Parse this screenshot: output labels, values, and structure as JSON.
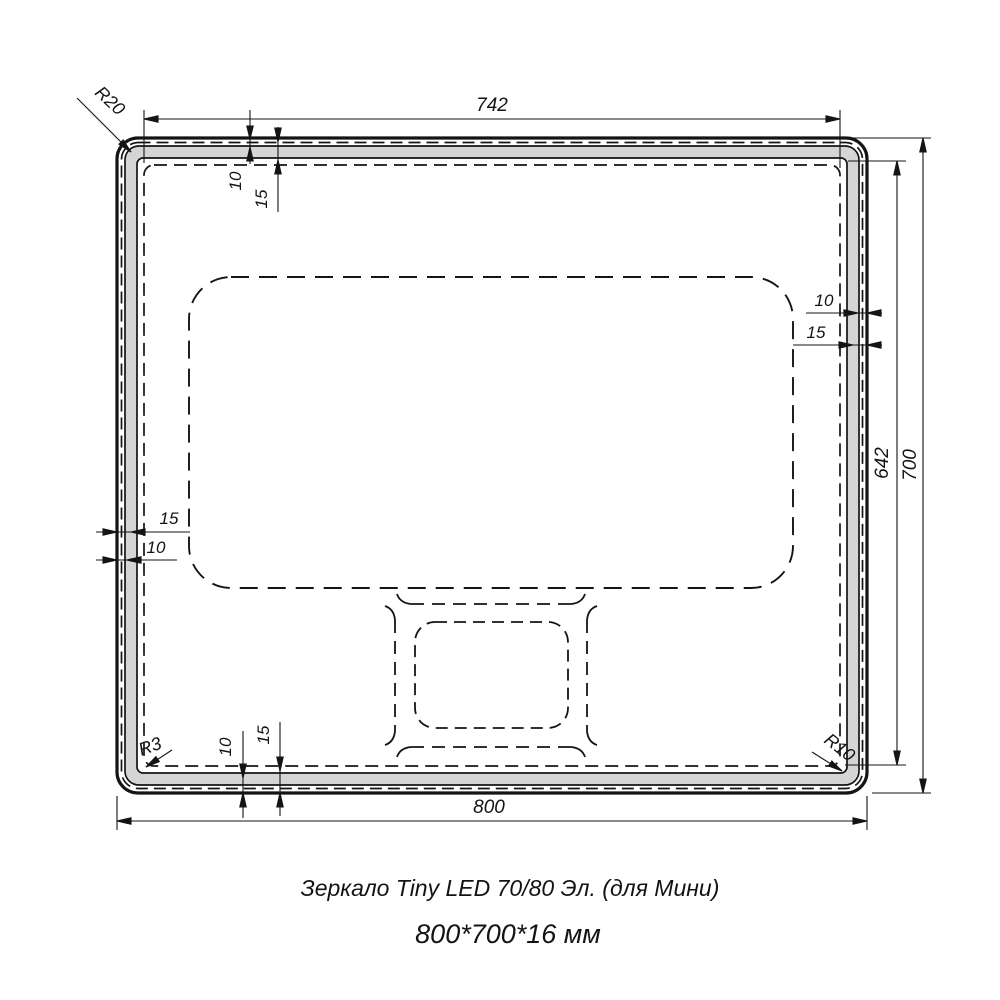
{
  "colors": {
    "line": "#141414",
    "band": "#d5d5d5",
    "background": "#ffffff"
  },
  "dimensions": {
    "top_width": "742",
    "bottom_width": "800",
    "right_inner_height": "642",
    "right_outer_height": "700",
    "top_left_offset_10": "10",
    "top_left_offset_15": "15",
    "bottom_left_offset_10": "10",
    "bottom_left_offset_15": "15",
    "right_offset_10": "10",
    "right_offset_15": "15",
    "left_offset_10": "10",
    "left_offset_15": "15"
  },
  "radii": {
    "outer_corner": "R20",
    "inner_bottom_left": "R3",
    "inner_bottom_right": "R10"
  },
  "caption": {
    "line1": "Зеркало Tiny LED 70/80 Эл. (для Мини)",
    "line2": "800*700*16 мм"
  }
}
